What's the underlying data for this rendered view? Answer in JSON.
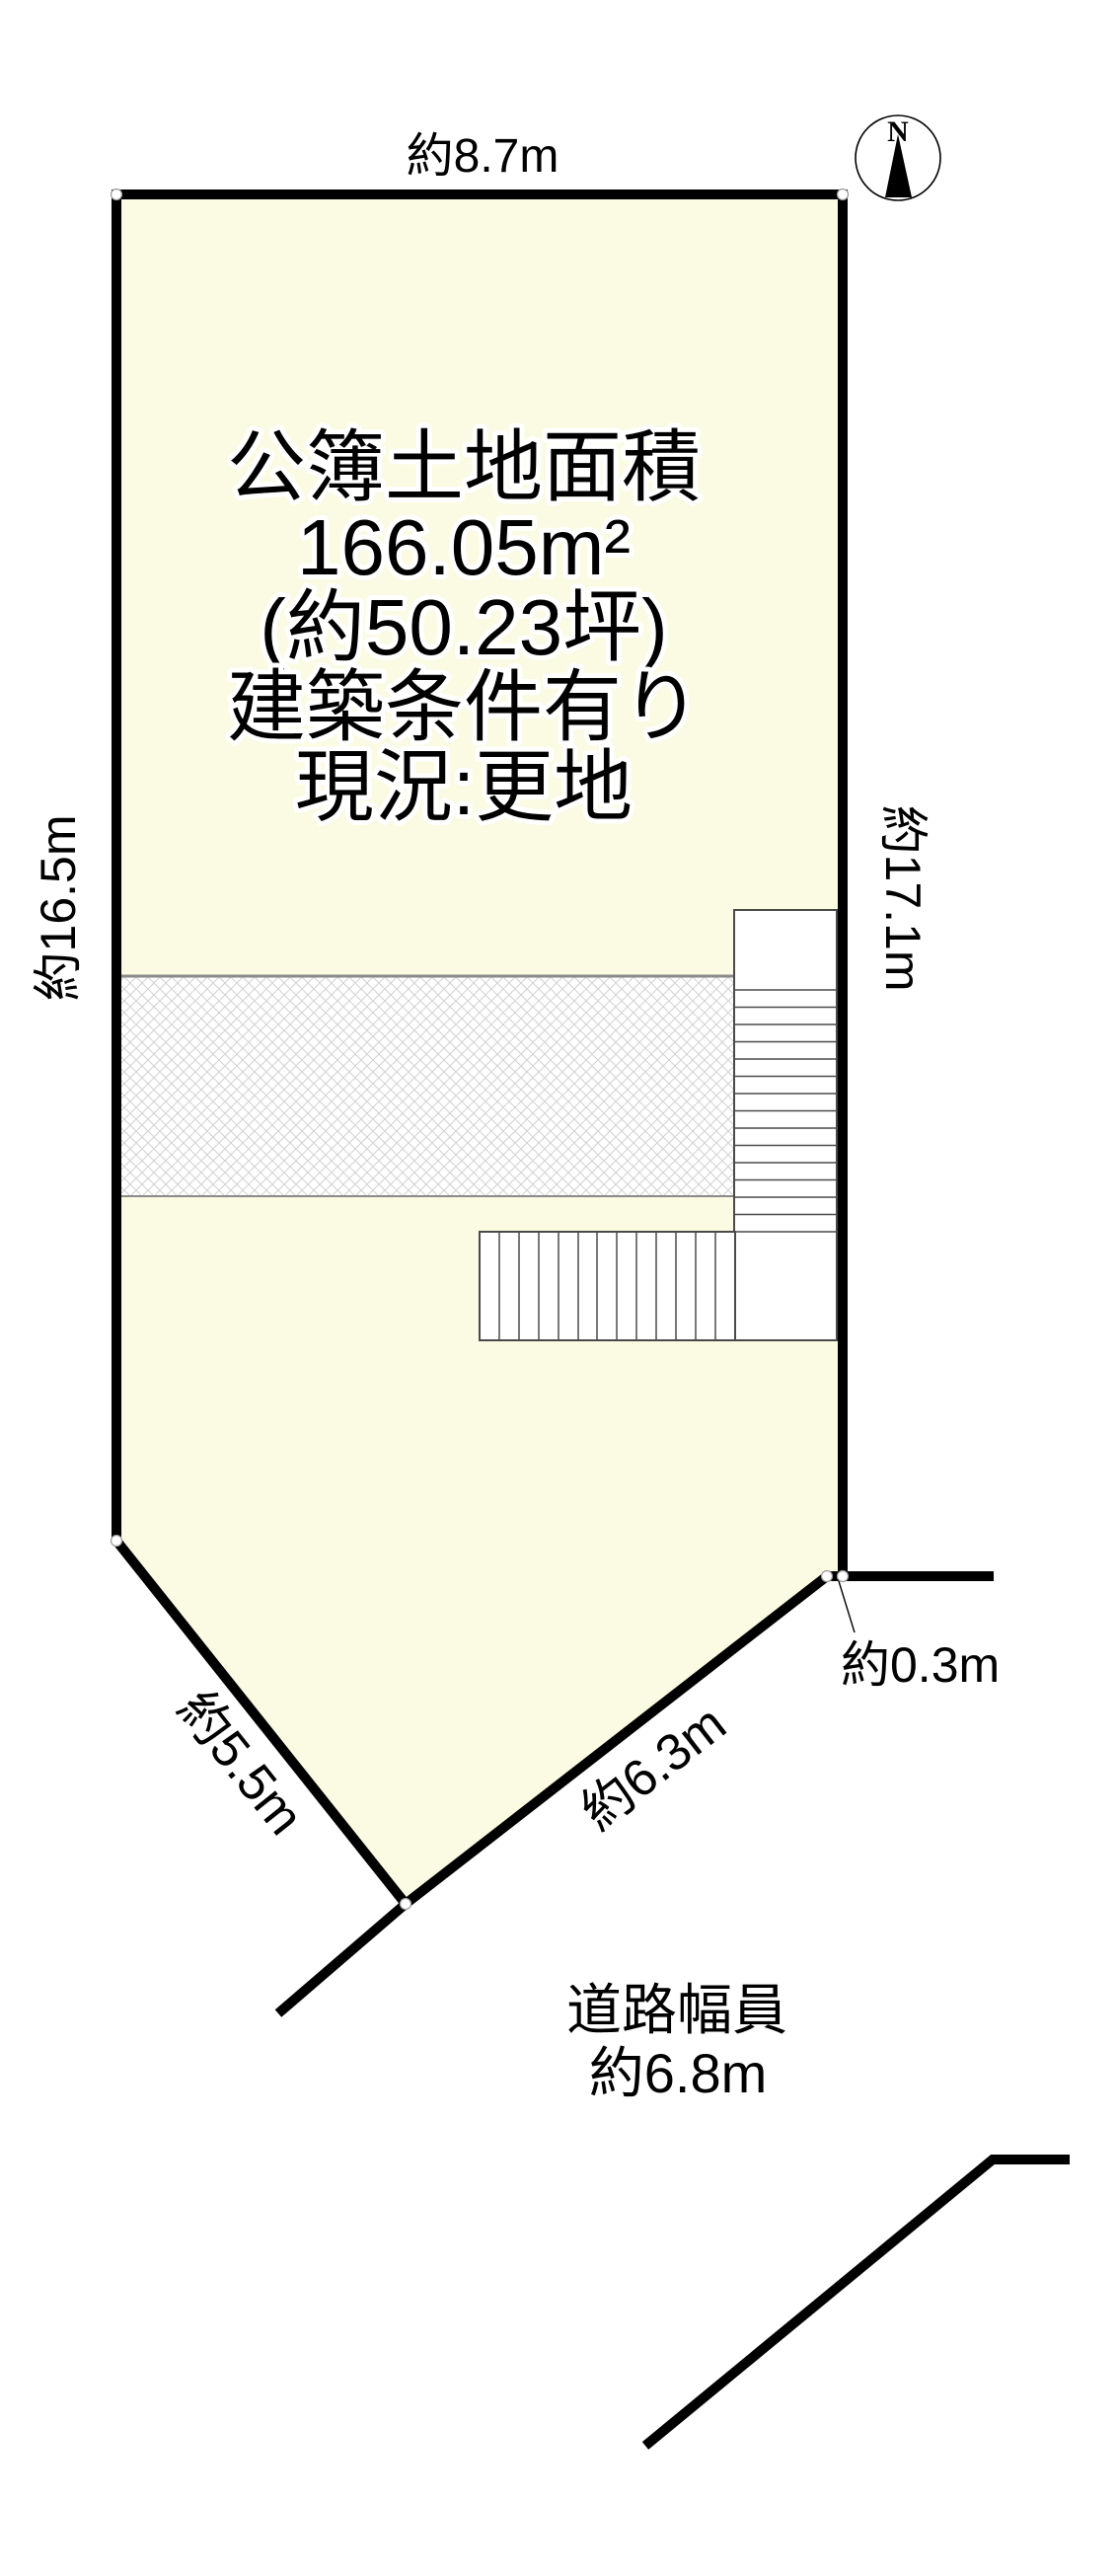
{
  "diagram_type": "land-plot-survey-diagram",
  "compass": {
    "north_label": "N"
  },
  "center_text": {
    "lines": [
      "公簿土地面積",
      "166.05m²",
      "(約50.23坪)",
      "建築条件有り",
      "現況:更地"
    ]
  },
  "dimensions": {
    "top_width": "約8.7m",
    "left_length": "約16.5m",
    "right_length": "約17.1m",
    "step_offset": "約0.3m",
    "lower_left_edge": "約5.5m",
    "lower_right_edge": "約6.3m"
  },
  "road": {
    "title": "道路幅員",
    "width": "約6.8m"
  },
  "colors": {
    "background": "#ffffff",
    "plot_fill": "#fbfae3",
    "outline": "#000000",
    "hatch_line": "#d2d2d2",
    "hatch_edge": "#8a8a8a",
    "stair_outline": "#4a4a4a",
    "vertex_dot_fill": "#ffffff",
    "vertex_dot_stroke": "#9a9a9a"
  }
}
